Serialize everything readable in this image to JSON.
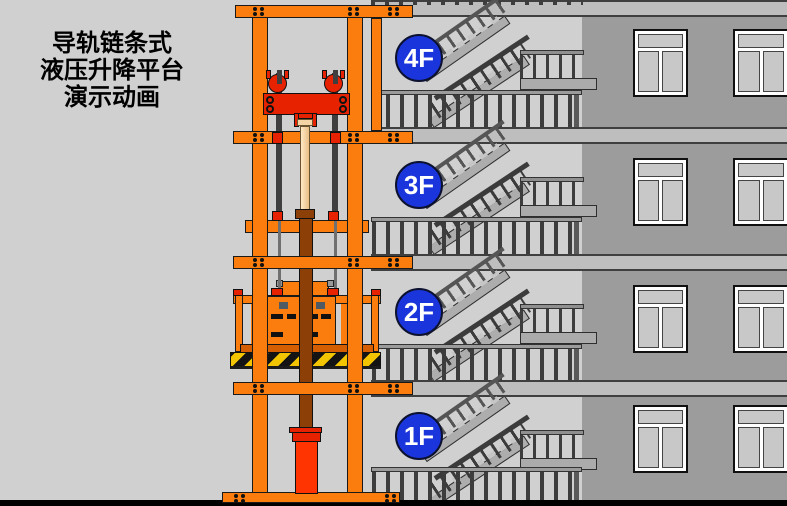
{
  "title": {
    "lines": [
      "导轨链条式",
      "液压升降平台",
      "演示动画"
    ]
  },
  "floors": [
    {
      "label": "4F"
    },
    {
      "label": "3F"
    },
    {
      "label": "2F"
    },
    {
      "label": "1F"
    }
  ],
  "scene": {
    "description_elements": {
      "lift": "guide-rail chain hydraulic lifting platform with cargo",
      "building": "four-storey building with scissor staircase and windows"
    }
  },
  "colors": {
    "background": "#D0D0D0",
    "frame_orange": "#FA7D0E",
    "accent_red": "#E62200",
    "cylinder_red": "#FF3400",
    "column_brown": "#8D3F08",
    "rod_beige": "#F5D5A5",
    "floor_badge_blue": "#1A35DC",
    "badge_text": "#FFFFFF",
    "wall_gray": "#9C9C9C",
    "slab_gray": "#BEBEBE",
    "stair_gray": "#ADADAD",
    "hazard_yellow": "#F2C500",
    "hazard_black": "#141414",
    "bottom_bar": "#000000",
    "title_text": "#000000"
  }
}
